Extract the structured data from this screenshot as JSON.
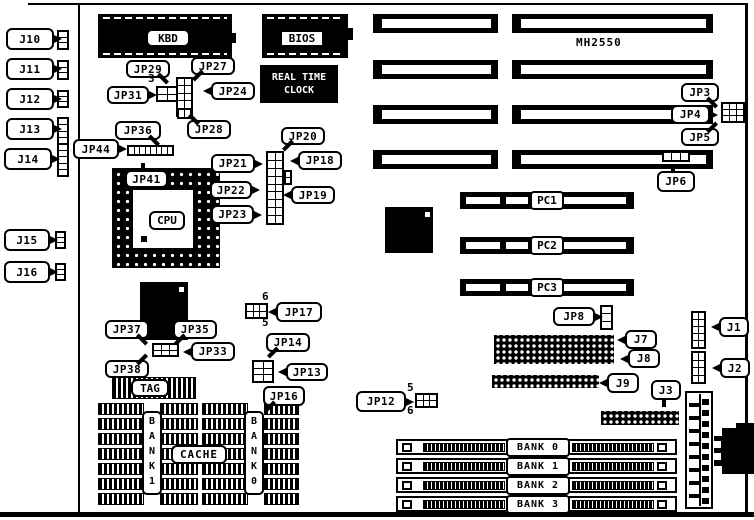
{
  "title": "MH2550",
  "chips": {
    "kbd": "KBD",
    "bios": "BIOS",
    "rtc_line1": "REAL TIME",
    "rtc_line2": "CLOCK",
    "cpu": "CPU"
  },
  "cache": {
    "label": "CACHE",
    "tag_label": "TAG",
    "bank_left": "BANK1",
    "bank_right": "BANK0",
    "blocks": [
      {
        "x": 98,
        "y": 403,
        "colA_w": 46,
        "colB_x": 160,
        "colB_w": 38,
        "rows": 7
      },
      {
        "x": 202,
        "y": 403,
        "colA_w": 46,
        "colB_x": 264,
        "colB_w": 35,
        "rows": 7
      }
    ]
  },
  "callouts": [
    {
      "text": "J10",
      "x": 6,
      "y": 28,
      "w": 48,
      "h": 22,
      "tail": "r"
    },
    {
      "text": "J11",
      "x": 6,
      "y": 58,
      "w": 48,
      "h": 22,
      "tail": "r"
    },
    {
      "text": "J12",
      "x": 6,
      "y": 88,
      "w": 48,
      "h": 22,
      "tail": "r"
    },
    {
      "text": "J13",
      "x": 6,
      "y": 118,
      "w": 48,
      "h": 22,
      "tail": "r"
    },
    {
      "text": "J14",
      "x": 4,
      "y": 148,
      "w": 48,
      "h": 22,
      "tail": "r"
    },
    {
      "text": "J15",
      "x": 4,
      "y": 229,
      "w": 46,
      "h": 22,
      "tail": "r"
    },
    {
      "text": "J16",
      "x": 4,
      "y": 261,
      "w": 46,
      "h": 22,
      "tail": "r"
    },
    {
      "text": "JP29",
      "x": 126,
      "y": 60,
      "w": 44,
      "h": 18,
      "tail": "br"
    },
    {
      "text": "JP27",
      "x": 191,
      "y": 57,
      "w": 44,
      "h": 18,
      "tail": "bl"
    },
    {
      "text": "JP31",
      "x": 107,
      "y": 86,
      "w": 42,
      "h": 18,
      "tail": "r"
    },
    {
      "text": "JP24",
      "x": 211,
      "y": 82,
      "w": 44,
      "h": 18,
      "tail": "l"
    },
    {
      "text": "JP28",
      "x": 187,
      "y": 120,
      "w": 44,
      "h": 19,
      "tail": "tl"
    },
    {
      "text": "JP36",
      "x": 115,
      "y": 121,
      "w": 46,
      "h": 19,
      "tail": "br"
    },
    {
      "text": "JP44",
      "x": 73,
      "y": 139,
      "w": 46,
      "h": 20,
      "tail": "r"
    },
    {
      "text": "JP41",
      "x": 125,
      "y": 170,
      "w": 43,
      "h": 18,
      "tail": "t"
    },
    {
      "text": "JP20",
      "x": 281,
      "y": 127,
      "w": 44,
      "h": 18,
      "tail": "bl"
    },
    {
      "text": "JP21",
      "x": 211,
      "y": 154,
      "w": 44,
      "h": 19,
      "tail": "r"
    },
    {
      "text": "JP18",
      "x": 298,
      "y": 151,
      "w": 44,
      "h": 19,
      "tail": "l"
    },
    {
      "text": "JP22",
      "x": 210,
      "y": 181,
      "w": 42,
      "h": 18,
      "tail": "r"
    },
    {
      "text": "JP19",
      "x": 291,
      "y": 186,
      "w": 44,
      "h": 18,
      "tail": "l"
    },
    {
      "text": "JP23",
      "x": 211,
      "y": 205,
      "w": 43,
      "h": 19,
      "tail": "r"
    },
    {
      "text": "JP3",
      "x": 681,
      "y": 83,
      "w": 38,
      "h": 19,
      "tail": "br"
    },
    {
      "text": "JP4",
      "x": 671,
      "y": 105,
      "w": 39,
      "h": 19,
      "tail": "r"
    },
    {
      "text": "JP5",
      "x": 681,
      "y": 128,
      "w": 38,
      "h": 18,
      "tail": "tr"
    },
    {
      "text": "JP6",
      "x": 657,
      "y": 171,
      "w": 38,
      "h": 21,
      "tail": "t"
    },
    {
      "text": "JP17",
      "x": 276,
      "y": 302,
      "w": 46,
      "h": 20,
      "tail": "l"
    },
    {
      "text": "JP14",
      "x": 266,
      "y": 333,
      "w": 44,
      "h": 19,
      "tail": "bl"
    },
    {
      "text": "JP13",
      "x": 286,
      "y": 363,
      "w": 42,
      "h": 18,
      "tail": "l"
    },
    {
      "text": "JP16",
      "x": 263,
      "y": 386,
      "w": 42,
      "h": 20,
      "tail": "bl"
    },
    {
      "text": "JP12",
      "x": 356,
      "y": 391,
      "w": 50,
      "h": 21,
      "tail": "r"
    },
    {
      "text": "JP37",
      "x": 105,
      "y": 320,
      "w": 44,
      "h": 19,
      "tail": "br"
    },
    {
      "text": "JP35",
      "x": 173,
      "y": 320,
      "w": 44,
      "h": 19,
      "tail": "bl"
    },
    {
      "text": "JP33",
      "x": 191,
      "y": 342,
      "w": 44,
      "h": 19,
      "tail": "l"
    },
    {
      "text": "JP38",
      "x": 105,
      "y": 360,
      "w": 44,
      "h": 18,
      "tail": "tr"
    },
    {
      "text": "JP8",
      "x": 553,
      "y": 307,
      "w": 42,
      "h": 19,
      "tail": "r"
    },
    {
      "text": "J7",
      "x": 625,
      "y": 330,
      "w": 32,
      "h": 19,
      "tail": "l"
    },
    {
      "text": "J8",
      "x": 628,
      "y": 349,
      "w": 32,
      "h": 19,
      "tail": "l"
    },
    {
      "text": "J9",
      "x": 607,
      "y": 373,
      "w": 32,
      "h": 20,
      "tail": "l"
    },
    {
      "text": "J3",
      "x": 651,
      "y": 380,
      "w": 30,
      "h": 20,
      "tail": "b"
    },
    {
      "text": "J1",
      "x": 719,
      "y": 317,
      "w": 30,
      "h": 20,
      "tail": "l"
    },
    {
      "text": "J2",
      "x": 720,
      "y": 358,
      "w": 30,
      "h": 20,
      "tail": "l"
    }
  ],
  "pin_numbers": [
    {
      "text": "3",
      "x": 148,
      "y": 72
    },
    {
      "text": "6",
      "x": 262,
      "y": 290
    },
    {
      "text": "5",
      "x": 262,
      "y": 316
    },
    {
      "text": "5",
      "x": 407,
      "y": 381
    },
    {
      "text": "6",
      "x": 407,
      "y": 404
    }
  ],
  "jumper_blocks": [
    {
      "name": "j10-connector",
      "x": 57,
      "y": 30,
      "w": 12,
      "h": 20,
      "cols": 1,
      "rows": 3
    },
    {
      "name": "j11-connector",
      "x": 57,
      "y": 60,
      "w": 12,
      "h": 20,
      "cols": 1,
      "rows": 3
    },
    {
      "name": "j12-connector",
      "x": 57,
      "y": 90,
      "w": 12,
      "h": 18,
      "cols": 1,
      "rows": 3
    },
    {
      "name": "j13-connector",
      "x": 57,
      "y": 117,
      "w": 12,
      "h": 28,
      "cols": 1,
      "rows": 4
    },
    {
      "name": "j14-connector",
      "x": 57,
      "y": 143,
      "w": 12,
      "h": 34,
      "cols": 1,
      "rows": 5
    },
    {
      "name": "j15-connector",
      "x": 55,
      "y": 231,
      "w": 11,
      "h": 18,
      "cols": 1,
      "rows": 3
    },
    {
      "name": "j16-connector",
      "x": 55,
      "y": 263,
      "w": 11,
      "h": 18,
      "cols": 1,
      "rows": 3
    },
    {
      "name": "jp31-block",
      "x": 156,
      "y": 86,
      "w": 22,
      "h": 16,
      "cols": 2,
      "rows": 2
    },
    {
      "name": "jp24-27-29-strip",
      "x": 176,
      "y": 77,
      "w": 17,
      "h": 40,
      "cols": 2,
      "rows": 5
    },
    {
      "name": "jp28-block",
      "x": 177,
      "y": 108,
      "w": 15,
      "h": 11,
      "cols": 2,
      "rows": 1
    },
    {
      "name": "jp20-23-strip",
      "x": 266,
      "y": 151,
      "w": 18,
      "h": 74,
      "cols": 2,
      "rows": 9
    },
    {
      "name": "jp19-nub",
      "x": 284,
      "y": 170,
      "w": 8,
      "h": 15,
      "cols": 1,
      "rows": 2
    },
    {
      "name": "jp44-strip",
      "x": 127,
      "y": 145,
      "w": 47,
      "h": 11,
      "cols": 8,
      "rows": 1
    },
    {
      "name": "jp3-4-5-block",
      "x": 721,
      "y": 102,
      "w": 24,
      "h": 21,
      "cols": 3,
      "rows": 3
    },
    {
      "name": "jp6-connector",
      "x": 662,
      "y": 151,
      "w": 28,
      "h": 11,
      "cols": 3,
      "rows": 1
    },
    {
      "name": "jp17-block",
      "x": 245,
      "y": 303,
      "w": 23,
      "h": 16,
      "cols": 3,
      "rows": 2
    },
    {
      "name": "jp13-14-block",
      "x": 252,
      "y": 360,
      "w": 22,
      "h": 23,
      "cols": 2,
      "rows": 3
    },
    {
      "name": "jp12-block",
      "x": 415,
      "y": 393,
      "w": 23,
      "h": 15,
      "cols": 3,
      "rows": 2
    },
    {
      "name": "jp33-block",
      "x": 152,
      "y": 343,
      "w": 27,
      "h": 14,
      "cols": 3,
      "rows": 2
    },
    {
      "name": "jp8-jumper",
      "x": 600,
      "y": 305,
      "w": 13,
      "h": 25,
      "cols": 1,
      "rows": 3
    },
    {
      "name": "j1-header",
      "x": 691,
      "y": 311,
      "w": 15,
      "h": 38,
      "cols": 2,
      "rows": 5
    },
    {
      "name": "j2-header",
      "x": 691,
      "y": 351,
      "w": 15,
      "h": 33,
      "cols": 2,
      "rows": 4
    }
  ],
  "isa_slots": [
    {
      "x": 373,
      "y": 14,
      "w": 125
    },
    {
      "x": 512,
      "y": 14,
      "w": 201
    },
    {
      "x": 373,
      "y": 60,
      "w": 125
    },
    {
      "x": 512,
      "y": 60,
      "w": 201
    },
    {
      "x": 373,
      "y": 105,
      "w": 125
    },
    {
      "x": 512,
      "y": 105,
      "w": 201
    },
    {
      "x": 373,
      "y": 150,
      "w": 125
    },
    {
      "x": 512,
      "y": 150,
      "w": 201
    }
  ],
  "pc_slots": [
    {
      "label": "PC1",
      "y": 192
    },
    {
      "label": "PC2",
      "y": 237
    },
    {
      "label": "PC3",
      "y": 279
    }
  ],
  "simm_slots": [
    {
      "label": "BANK 0",
      "y": 439
    },
    {
      "label": "BANK 1",
      "y": 458
    },
    {
      "label": "BANK 2",
      "y": 477
    },
    {
      "label": "BANK 3",
      "y": 496
    }
  ],
  "pin_headers": [
    {
      "name": "j7-j8-header",
      "x": 494,
      "y": 335,
      "w": 120,
      "h": 29
    },
    {
      "name": "j9-header",
      "x": 492,
      "y": 375,
      "w": 107,
      "h": 13
    },
    {
      "name": "j3-header",
      "x": 601,
      "y": 411,
      "w": 78,
      "h": 14
    }
  ]
}
